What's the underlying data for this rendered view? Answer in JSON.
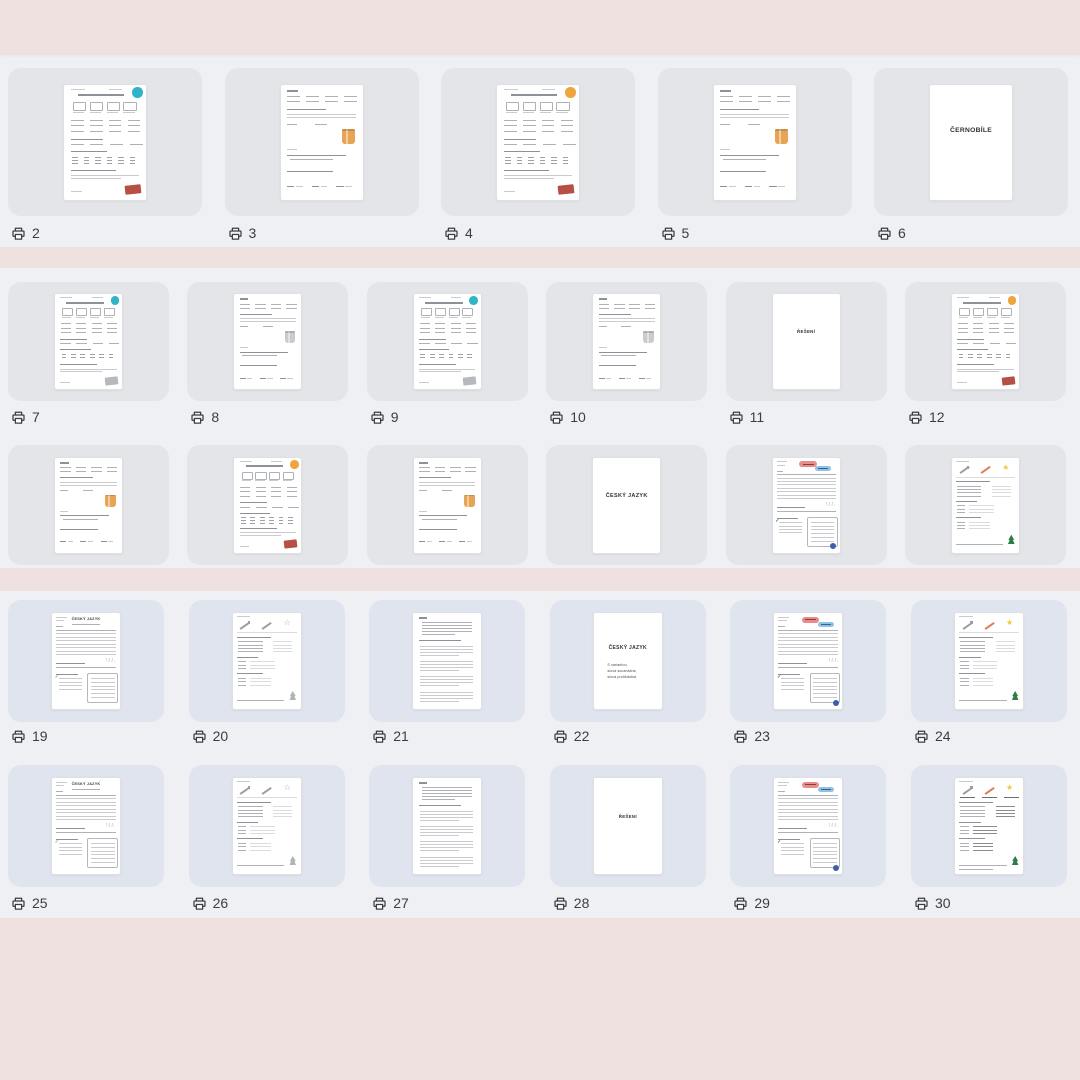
{
  "view": {
    "description_label": "Page thumbnail grid"
  },
  "colors": {
    "band_pink": "#efe1df",
    "content_bg": "#eef0f3",
    "card_gray": "#e4e5e9",
    "card_blue": "#e0e4ee",
    "page_white": "#ffffff",
    "label_text": "#3a3e43",
    "teal": "#2fb5c8",
    "orange": "#f0a43c",
    "red": "#b65045",
    "gray_accent": "#b6b9bd",
    "bag_orange": "#e8a455",
    "bag_gray": "#c9cbce",
    "red_pill": "#e98b8b",
    "blue_pill": "#8fc1e9",
    "yellow_star": "#f4c63f",
    "green_tree": "#2e7d46",
    "green_check": "#3f8f4f",
    "blue_dot": "#3d5ea8",
    "pencil_orange": "#e07b54"
  },
  "label_icon": "printer-icon",
  "rows": [
    {
      "name": "row-1",
      "labels_hidden": false,
      "pages": [
        {
          "label": "2",
          "kind": "math_a",
          "badge": "teal",
          "stamp": "red"
        },
        {
          "label": "3",
          "kind": "math_b",
          "bag": "bag_orange"
        },
        {
          "label": "4",
          "kind": "math_a",
          "badge": "orange",
          "stamp": "red"
        },
        {
          "label": "5",
          "kind": "math_b",
          "bag": "bag_orange"
        },
        {
          "label": "6",
          "kind": "cover",
          "text": "ČERNOBÍLE"
        }
      ]
    },
    {
      "name": "row-2",
      "labels_hidden": false,
      "pages": [
        {
          "label": "7",
          "kind": "math_a",
          "badge": "teal",
          "stamp": "gray_accent"
        },
        {
          "label": "8",
          "kind": "math_b",
          "bag": "bag_gray"
        },
        {
          "label": "9",
          "kind": "math_a",
          "badge": "teal",
          "stamp": "gray_accent"
        },
        {
          "label": "10",
          "kind": "math_b",
          "bag": "bag_gray"
        },
        {
          "label": "11",
          "kind": "cover",
          "text": "ŘEŠENÍ"
        },
        {
          "label": "12",
          "kind": "math_a",
          "badge": "orange",
          "stamp": "red"
        }
      ]
    },
    {
      "name": "row-3",
      "labels_hidden": true,
      "pages": [
        {
          "label": "13",
          "kind": "math_b",
          "bag": "bag_orange"
        },
        {
          "label": "14",
          "kind": "math_a",
          "badge": "orange",
          "stamp": "red"
        },
        {
          "label": "15",
          "kind": "math_b",
          "bag": "bag_orange"
        },
        {
          "label": "16",
          "kind": "cover",
          "text": "ČESKÝ JAZYK"
        },
        {
          "label": "17",
          "kind": "lang_a",
          "pills": true,
          "color": true
        },
        {
          "label": "18",
          "kind": "lang_b",
          "color": true
        }
      ]
    },
    {
      "name": "row-4",
      "labels_hidden": false,
      "pages": [
        {
          "label": "19",
          "kind": "lang_a",
          "title": "ČESKÝ JAZYK"
        },
        {
          "label": "20",
          "kind": "lang_b"
        },
        {
          "label": "21",
          "kind": "text_page"
        },
        {
          "label": "22",
          "kind": "cover",
          "text": "ČESKÝ JAZYK",
          "subtitle": [
            "S variantou",
            "slova souznačná,",
            "slova protikladná"
          ]
        },
        {
          "label": "23",
          "kind": "lang_a",
          "pills": true,
          "color": true
        },
        {
          "label": "24",
          "kind": "lang_b",
          "color": true
        }
      ]
    },
    {
      "name": "row-5",
      "labels_hidden": false,
      "pages": [
        {
          "label": "25",
          "kind": "lang_a",
          "title": "ČESKÝ JAZYK"
        },
        {
          "label": "26",
          "kind": "lang_b"
        },
        {
          "label": "27",
          "kind": "text_page"
        },
        {
          "label": "28",
          "kind": "cover",
          "text": "ŘEŠENÍ"
        },
        {
          "label": "29",
          "kind": "lang_a",
          "pills": true,
          "color": true
        },
        {
          "label": "30",
          "kind": "lang_b",
          "color": true,
          "answers": true
        }
      ]
    }
  ]
}
